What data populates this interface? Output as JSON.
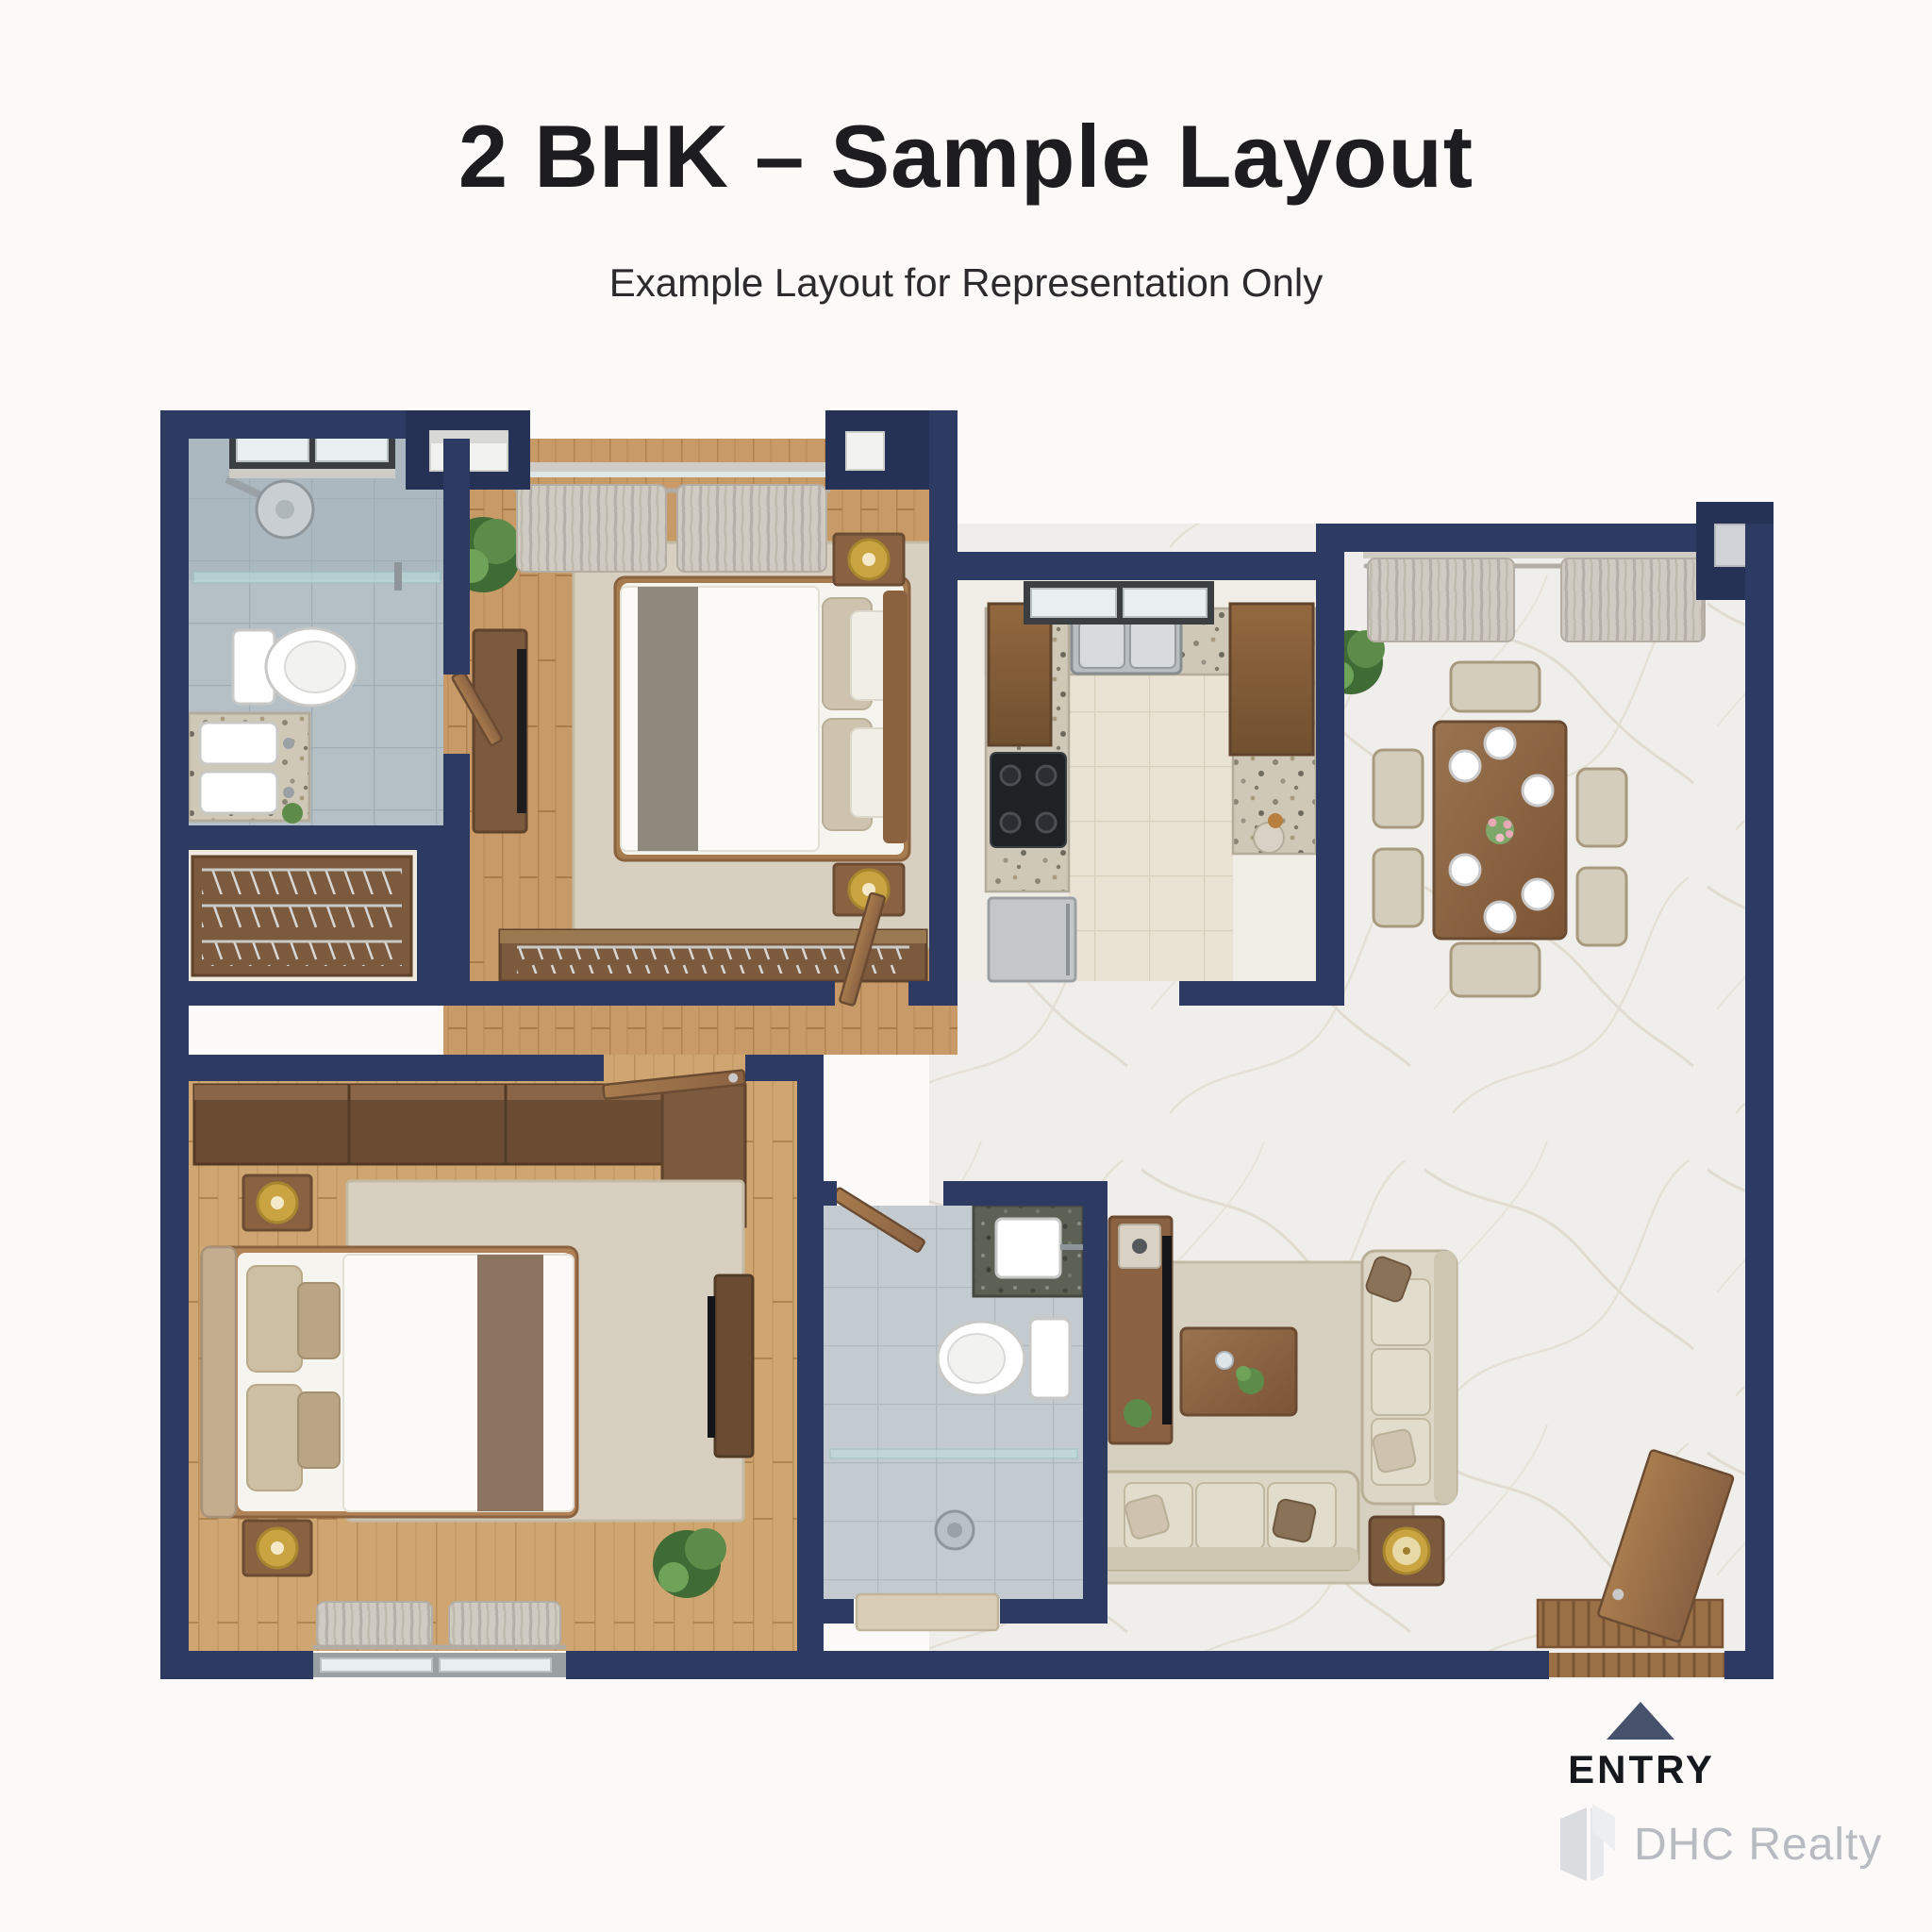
{
  "header": {
    "title": "2 BHK – Sample Layout",
    "subtitle": "Example Layout for Representation Only"
  },
  "entry": {
    "label": "ENTRY"
  },
  "watermark": {
    "brand": "DHC Realty",
    "logo_icon": "open-door-cube-logo"
  },
  "colors": {
    "page_bg": "#fbfaf8",
    "title": "#1d1d1f",
    "subtitle": "#2b2b2e",
    "wall": "#2d3b63",
    "wall_dark": "#253255",
    "entry_arrow": "#46526b",
    "entry_label": "#15181d",
    "watermark_text": "#b8bcc2",
    "watermark_logo": "#dadce0",
    "wood_floor": "#c79a67",
    "wood_floor_dark": "#b2824f",
    "marble": "#f0eeea",
    "marble_vein": "#ddd6ca",
    "bath_tile": "#b4c0c6",
    "bath_tile2": "#c3cbd0",
    "kitchen_tile": "#eae2d2",
    "counter": "#cfc8b6",
    "cabinet_wood": "#8a6242",
    "furniture_wood": "#8a6547",
    "dark_wood": "#6b4c33",
    "fabric": "#ddd6c6",
    "fabric_dark": "#cfc6b2",
    "rug": "#d7d0c0",
    "white_goods": "#ffffff",
    "glass": "#bfe0e0",
    "curtain": "#cfcac2",
    "gold": "#c9a441",
    "plant": "#4e7c3f",
    "door_wood": "#9a7046",
    "window_frame": "#3c3f42"
  }
}
